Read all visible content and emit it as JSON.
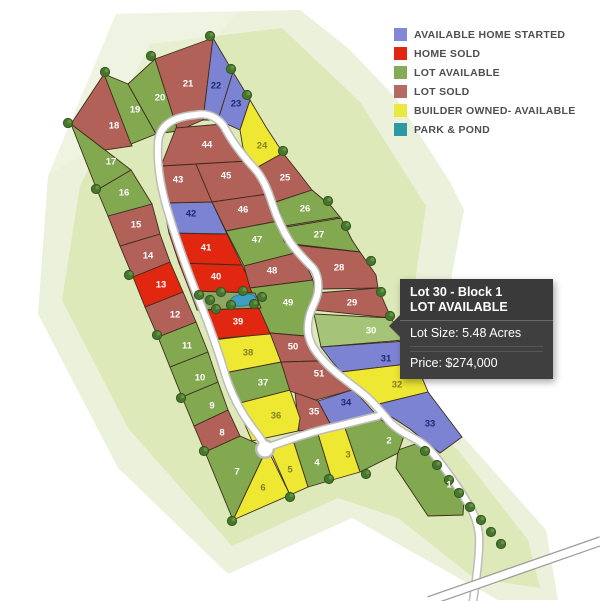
{
  "legend": {
    "items": [
      {
        "key": "available-home-started",
        "label": "AVAILABLE HOME STARTED",
        "color": "#8486d8"
      },
      {
        "key": "home-sold",
        "label": "HOME SOLD",
        "color": "#e1270f"
      },
      {
        "key": "lot-available",
        "label": "LOT AVAILABLE",
        "color": "#86ab56"
      },
      {
        "key": "lot-sold",
        "label": "LOT SOLD",
        "color": "#b46b63"
      },
      {
        "key": "builder-owned",
        "label": "BUILDER OWNED- AVAILABLE",
        "color": "#eae93f"
      },
      {
        "key": "park-pond",
        "label": "PARK & POND",
        "color": "#2b9aa4"
      }
    ]
  },
  "tooltip": {
    "title": "Lot 30 - Block 1",
    "status": "LOT AVAILABLE",
    "size": "Lot Size: 5.48 Acres",
    "price": "Price: $274,000"
  },
  "colors": {
    "available-home-started": "#7d83d3",
    "home-sold": "#e1270f",
    "lot-available": "#82a950",
    "lot-sold": "#b26159",
    "builder-owned": "#eee832",
    "selected": "#a6c478",
    "park": "#8fa763",
    "pond": "#3d9fc4",
    "lot_border": "#3f2d1d",
    "label_on_blue": "#1b2a70",
    "label_on_yellow": "#827f2a",
    "label_default": "#ffffff"
  },
  "map": {
    "selected_lot": "30",
    "lots": [
      {
        "n": "1",
        "status": "lot-available",
        "points": "398,450 424,441 448,470 464,498 463,515 428,516 396,468",
        "label": [
          449,
          485
        ]
      },
      {
        "n": "2",
        "status": "lot-available",
        "points": "345,428 380,419 392,428 404,436 398,453 360,472",
        "label": [
          389,
          441
        ]
      },
      {
        "n": "3",
        "status": "builder-owned",
        "points": "318,434 345,428 360,472 332,480",
        "label": [
          348,
          455
        ]
      },
      {
        "n": "4",
        "status": "lot-available",
        "points": "293,440 318,434 332,480 308,487",
        "label": [
          317,
          463
        ]
      },
      {
        "n": "5",
        "status": "builder-owned",
        "points": "269,447 293,440 308,487 290,495",
        "label": [
          290,
          470
        ]
      },
      {
        "n": "6",
        "status": "builder-owned",
        "points": "267,448 290,495 233,520",
        "label": [
          263,
          488
        ]
      },
      {
        "n": "7",
        "status": "lot-available",
        "points": "205,452 240,436 267,448 233,520",
        "label": [
          237,
          472
        ]
      },
      {
        "n": "8",
        "status": "lot-sold",
        "points": "194,426 228,410 240,436 205,452",
        "label": [
          222,
          433
        ]
      },
      {
        "n": "9",
        "status": "lot-available",
        "points": "182,397 218,382 228,410 194,426",
        "label": [
          212,
          406
        ]
      },
      {
        "n": "10",
        "status": "lot-available",
        "points": "170,367 208,352 218,382 182,397",
        "label": [
          200,
          378
        ]
      },
      {
        "n": "11",
        "status": "lot-available",
        "points": "158,337 196,322 208,352 170,367",
        "label": [
          187,
          346
        ]
      },
      {
        "n": "12",
        "status": "lot-sold",
        "points": "145,307 183,292 196,322 158,337",
        "label": [
          175,
          315
        ]
      },
      {
        "n": "13",
        "status": "home-sold",
        "points": "133,277 170,262 183,292 145,307",
        "label": [
          161,
          285
        ]
      },
      {
        "n": "14",
        "status": "lot-sold",
        "points": "120,246 160,234 170,262 133,277",
        "label": [
          148,
          256
        ]
      },
      {
        "n": "15",
        "status": "lot-sold",
        "points": "108,216 152,204 160,234 120,246",
        "label": [
          136,
          225
        ]
      },
      {
        "n": "16",
        "status": "lot-available",
        "points": "97,190 131,170 152,204 108,216",
        "label": [
          124,
          193
        ]
      },
      {
        "n": "17",
        "status": "lot-available",
        "points": "71,124 105,150 131,170 97,190",
        "label": [
          111,
          162
        ]
      },
      {
        "n": "18",
        "status": "lot-sold",
        "points": "71,124 104,74 132,146 105,150",
        "label": [
          114,
          126
        ]
      },
      {
        "n": "19",
        "status": "lot-available",
        "points": "104,74 128,84 156,134 131,144",
        "label": [
          135,
          110
        ]
      },
      {
        "n": "20",
        "status": "lot-available",
        "points": "128,84 155,59 178,131 156,134",
        "label": [
          160,
          98
        ]
      },
      {
        "n": "21",
        "status": "lot-sold",
        "points": "155,59 213,38 203,120 178,131",
        "label": [
          188,
          84
        ]
      },
      {
        "n": "22",
        "status": "available-home-started",
        "points": "213,38 233,72 218,120 203,120",
        "label": [
          216,
          86
        ]
      },
      {
        "n": "23",
        "status": "available-home-started",
        "points": "233,72 250,100 240,130 218,120",
        "label": [
          236,
          104
        ]
      },
      {
        "n": "24",
        "status": "builder-owned",
        "points": "240,130 250,100 266,127 283,153 256,168 243,148",
        "label": [
          262,
          146
        ]
      },
      {
        "n": "25",
        "status": "lot-sold",
        "points": "256,168 283,153 302,177 312,190 275,202 266,179",
        "label": [
          285,
          178
        ]
      },
      {
        "n": "26",
        "status": "lot-available",
        "points": "276,202 312,190 331,206 340,217 285,226",
        "label": [
          305,
          209
        ]
      },
      {
        "n": "27",
        "status": "lot-available",
        "points": "286,227 341,218 352,240 360,252 293,244",
        "label": [
          319,
          235
        ]
      },
      {
        "n": "28",
        "status": "lot-sold",
        "points": "294,245 360,252 376,275 378,288 322,289 305,258",
        "label": [
          339,
          268
        ]
      },
      {
        "n": "29",
        "status": "lot-sold",
        "points": "316,293 378,288 391,318 313,310",
        "label": [
          352,
          303
        ]
      },
      {
        "n": "30",
        "status": "lot-available",
        "selected": true,
        "points": "314,314 391,318 404,340 321,347",
        "label": [
          371,
          331
        ]
      },
      {
        "n": "31",
        "status": "available-home-started",
        "points": "321,347 406,341 416,363 341,372 330,359",
        "label": [
          386,
          359
        ]
      },
      {
        "n": "32",
        "status": "builder-owned",
        "points": "341,372 416,363 428,392 379,404",
        "label": [
          397,
          385
        ]
      },
      {
        "n": "33",
        "status": "available-home-started",
        "points": "379,404 428,392 462,437 440,453 410,429 390,416",
        "label": [
          430,
          424
        ]
      },
      {
        "n": "34",
        "status": "available-home-started",
        "points": "318,401 352,390 360,397 373,411 379,419 332,427",
        "label": [
          346,
          403
        ]
      },
      {
        "n": "35",
        "status": "lot-sold",
        "points": "295,392 318,401 332,427 299,431",
        "label": [
          314,
          412
        ]
      },
      {
        "n": "36",
        "status": "builder-owned",
        "points": "236,404 290,390 300,418 298,431 252,441",
        "label": [
          276,
          416
        ]
      },
      {
        "n": "37",
        "status": "lot-available",
        "points": "224,373 281,362 290,390 236,404",
        "label": [
          263,
          383
        ]
      },
      {
        "n": "38",
        "status": "builder-owned",
        "points": "213,340 272,333 281,362 224,373",
        "label": [
          248,
          353
        ]
      },
      {
        "n": "39",
        "status": "home-sold",
        "points": "202,310 261,308 270,334 213,339",
        "label": [
          238,
          322
        ]
      },
      {
        "n": "40",
        "status": "home-sold",
        "points": "179,263 242,265 255,293 190,291",
        "label": [
          216,
          277
        ]
      },
      {
        "n": "41",
        "status": "home-sold",
        "points": "169,233 227,234 242,265 179,263",
        "label": [
          206,
          248
        ]
      },
      {
        "n": "42",
        "status": "available-home-started",
        "points": "163,203 212,202 227,234 169,233",
        "label": [
          191,
          214
        ]
      },
      {
        "n": "43",
        "status": "lot-sold",
        "points": "161,166 196,164 212,202 163,203",
        "label": [
          178,
          180
        ]
      },
      {
        "n": "44",
        "status": "lot-sold",
        "points": "176,128 222,124 238,147 249,161 196,164 161,166",
        "label": [
          207,
          145
        ]
      },
      {
        "n": "45",
        "status": "lot-sold",
        "points": "196,164 249,161 259,175 268,194 212,202",
        "label": [
          226,
          176
        ]
      },
      {
        "n": "46",
        "status": "lot-sold",
        "points": "212,202 268,194 272,205 278,221 226,231",
        "label": [
          243,
          210
        ]
      },
      {
        "n": "47",
        "status": "lot-available",
        "points": "226,231 278,221 284,241 295,253 244,266",
        "label": [
          257,
          240
        ]
      },
      {
        "n": "48",
        "status": "lot-sold",
        "points": "244,266 295,253 306,264 313,280 250,288",
        "label": [
          272,
          271
        ]
      },
      {
        "n": "49",
        "status": "lot-available",
        "points": "250,288 313,280 315,292 310,309 305,322 306,336 270,333",
        "label": [
          288,
          303
        ]
      },
      {
        "n": "50",
        "status": "lot-sold",
        "points": "270,333 305,336 311,350 318,361 281,362",
        "label": [
          293,
          347
        ]
      },
      {
        "n": "51",
        "status": "lot-sold",
        "points": "281,362 318,361 342,382 352,390 316,400 290,391",
        "label": [
          319,
          374
        ]
      }
    ],
    "park": {
      "points": "190,291 255,293 261,308 197,310"
    },
    "pond": {
      "cx": 243,
      "cy": 300,
      "rx": 13,
      "ry": 6
    },
    "trees": [
      [
        105,
        72
      ],
      [
        151,
        56
      ],
      [
        210,
        36
      ],
      [
        231,
        69
      ],
      [
        247,
        95
      ],
      [
        68,
        123
      ],
      [
        96,
        189
      ],
      [
        129,
        275
      ],
      [
        157,
        335
      ],
      [
        181,
        398
      ],
      [
        204,
        451
      ],
      [
        232,
        521
      ],
      [
        290,
        497
      ],
      [
        329,
        479
      ],
      [
        366,
        474
      ],
      [
        283,
        151
      ],
      [
        328,
        201
      ],
      [
        346,
        226
      ],
      [
        371,
        261
      ],
      [
        381,
        292
      ],
      [
        390,
        316
      ],
      [
        425,
        451
      ],
      [
        437,
        465
      ],
      [
        449,
        480
      ],
      [
        459,
        493
      ],
      [
        470,
        507
      ],
      [
        481,
        520
      ],
      [
        491,
        532
      ],
      [
        501,
        544
      ],
      [
        210,
        300
      ],
      [
        221,
        292
      ],
      [
        231,
        305
      ],
      [
        243,
        291
      ],
      [
        254,
        304
      ],
      [
        262,
        297
      ],
      [
        216,
        309
      ],
      [
        199,
        295
      ]
    ]
  }
}
